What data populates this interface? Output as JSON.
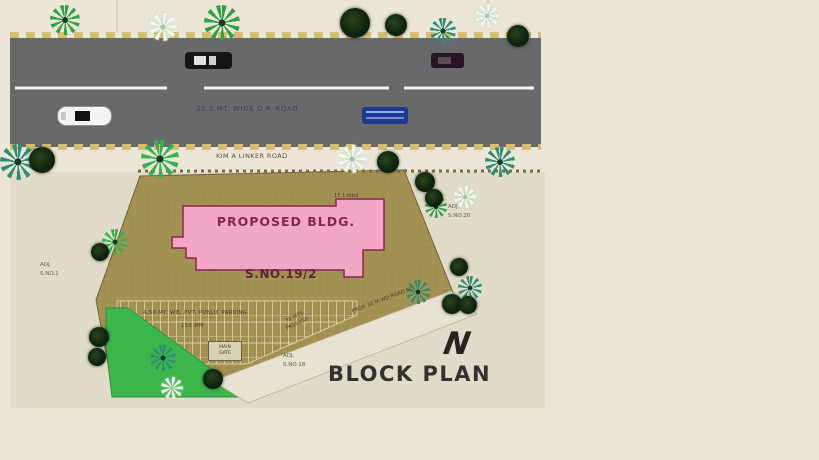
{
  "plan": {
    "title": "BLOCK PLAN",
    "north_label": "N"
  },
  "road": {
    "name": "30.0 MT. WIDE D.P. ROAD",
    "edge_label": "KIM A LINKER ROAD"
  },
  "site": {
    "building_label": "PROPOSED BLDG.",
    "plot_label": "S.NO.19/2",
    "dim_label": "17.1 mtrs"
  },
  "parking": {
    "label1": "4.50 MT. WD. PVT. PUBLIC PARKING",
    "label2": "150 MM",
    "gate_label1": "MAIN",
    "gate_label2": "GATE"
  },
  "passage": {
    "line1": "30 MTS",
    "line2": "PASSAGE",
    "road_no_label": "PROP. 30 M WD ROAD NO"
  },
  "adjacent": {
    "left1": "ADJ.",
    "left2": "S.NO.1",
    "right1": "ADJ.",
    "right2": "S.NO.20",
    "bottom1": "ADJ.",
    "bottom2": "S.NO.18"
  },
  "colors": {
    "road_gray": "#67696b",
    "site_khaki": "#a29052",
    "building_pink": "#f2a7c6",
    "building_border": "#8c2550",
    "lawn_green": "#3cb64b",
    "dash_tan": "#d6bd72",
    "background_cream": "#ece6d8"
  },
  "scene": {
    "trees": [
      {
        "kind": "palm",
        "x": 18,
        "y": 162,
        "s": 36,
        "c": "#2e8d74"
      },
      {
        "kind": "palm",
        "x": 65,
        "y": 20,
        "s": 30,
        "c": "#2fa047"
      },
      {
        "kind": "palm",
        "x": 222,
        "y": 23,
        "s": 36,
        "c": "#2fa047"
      },
      {
        "kind": "palm",
        "x": 160,
        "y": 159,
        "s": 38,
        "c": "#35b14f"
      },
      {
        "kind": "palm",
        "x": 443,
        "y": 31,
        "s": 26,
        "c": "#2e8d74"
      },
      {
        "kind": "palm",
        "x": 500,
        "y": 162,
        "s": 30,
        "c": "#2e8d74"
      },
      {
        "kind": "palm",
        "x": 115,
        "y": 242,
        "s": 26,
        "c": "#35b14f"
      },
      {
        "kind": "palm",
        "x": 436,
        "y": 207,
        "s": 22,
        "c": "#2fa047"
      },
      {
        "kind": "palm",
        "x": 470,
        "y": 288,
        "s": 24,
        "c": "#2e8d74"
      },
      {
        "kind": "palm",
        "x": 418,
        "y": 292,
        "s": 24,
        "c": "#2e8d74"
      },
      {
        "kind": "palm",
        "x": 163,
        "y": 358,
        "s": 26,
        "c": "#2e8d74"
      },
      {
        "kind": "dark",
        "x": 42,
        "y": 160,
        "s": 26
      },
      {
        "kind": "dark",
        "x": 355,
        "y": 23,
        "s": 30
      },
      {
        "kind": "dark",
        "x": 396,
        "y": 25,
        "s": 22
      },
      {
        "kind": "dark",
        "x": 518,
        "y": 36,
        "s": 22
      },
      {
        "kind": "dark",
        "x": 425,
        "y": 182,
        "s": 20
      },
      {
        "kind": "dark",
        "x": 434,
        "y": 198,
        "s": 18
      },
      {
        "kind": "dark",
        "x": 388,
        "y": 162,
        "s": 22
      },
      {
        "kind": "dark",
        "x": 459,
        "y": 267,
        "s": 18
      },
      {
        "kind": "dark",
        "x": 452,
        "y": 304,
        "s": 20
      },
      {
        "kind": "dark",
        "x": 468,
        "y": 305,
        "s": 18
      },
      {
        "kind": "dark",
        "x": 100,
        "y": 252,
        "s": 18
      },
      {
        "kind": "dark",
        "x": 99,
        "y": 337,
        "s": 20
      },
      {
        "kind": "dark",
        "x": 97,
        "y": 357,
        "s": 18
      },
      {
        "kind": "dark",
        "x": 213,
        "y": 379,
        "s": 20
      },
      {
        "kind": "flower",
        "x": 163,
        "y": 27,
        "s": 28
      },
      {
        "kind": "flower",
        "x": 487,
        "y": 16,
        "s": 24
      },
      {
        "kind": "flower",
        "x": 352,
        "y": 159,
        "s": 28
      },
      {
        "kind": "flower",
        "x": 465,
        "y": 197,
        "s": 22
      },
      {
        "kind": "flower",
        "x": 172,
        "y": 388,
        "s": 22
      }
    ],
    "cars": [
      {
        "type": "black",
        "x": 185,
        "y": 52,
        "w": 47,
        "h": 17
      },
      {
        "type": "maroon",
        "x": 431,
        "y": 53,
        "w": 33,
        "h": 15
      },
      {
        "type": "white",
        "x": 57,
        "y": 106,
        "w": 55,
        "h": 20
      },
      {
        "type": "blue",
        "x": 362,
        "y": 107,
        "w": 46,
        "h": 17
      }
    ]
  }
}
